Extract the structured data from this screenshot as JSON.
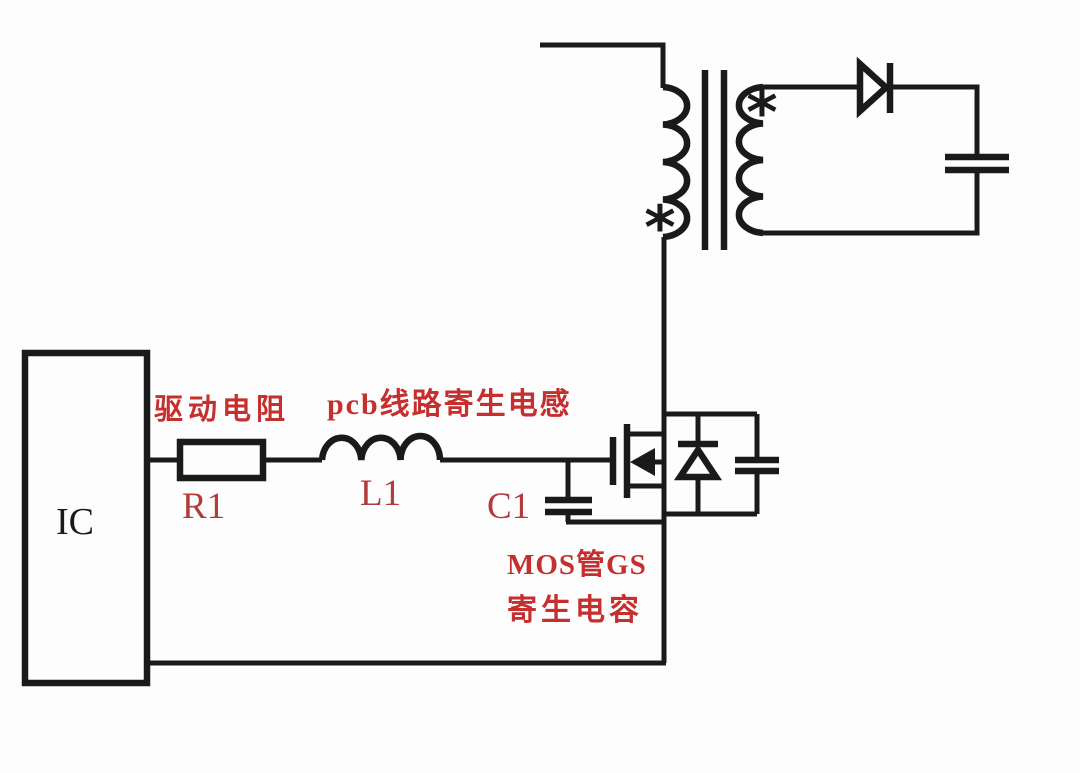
{
  "colors": {
    "background": "#fdfdfd",
    "line": "#1a1a1a",
    "label_cn": "#c5302f",
    "label_ref": "#b03a3c"
  },
  "labels": {
    "ic": "IC",
    "drive_resistor_cn": "驱动电阻",
    "drive_resistor_ref": "R1",
    "pcb_inductance_cn": "pcb线路寄生电感",
    "pcb_inductance_ref": "L1",
    "gs_capacitance_ref": "C1",
    "gs_capacitance_cn_line1": "MOS管GS",
    "gs_capacitance_cn_line2": "寄生电容",
    "primary_dot_marker": "*",
    "secondary_dot_marker": "*"
  }
}
